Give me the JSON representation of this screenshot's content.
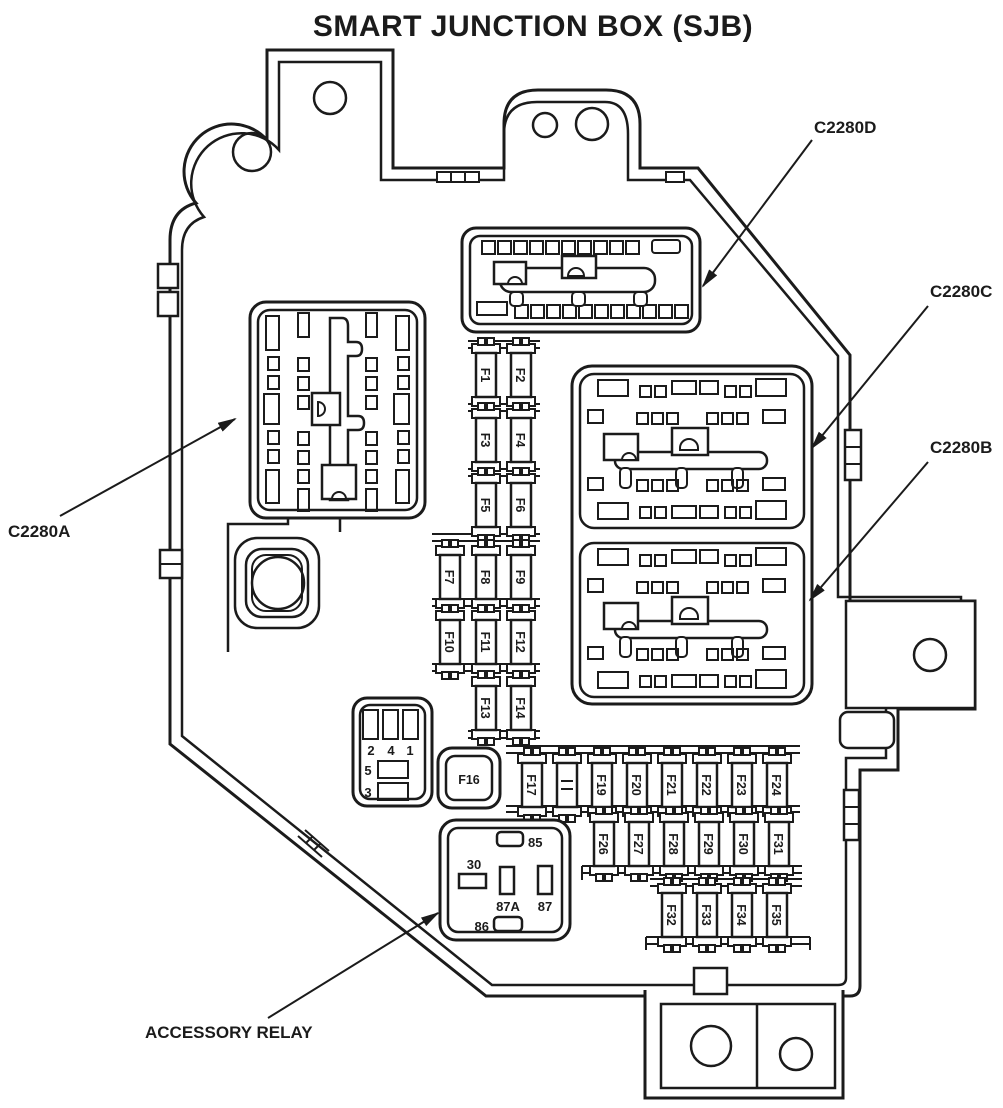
{
  "title": "SMART JUNCTION BOX (SJB)",
  "colors": {
    "ink": "#1b1b1b",
    "paper": "#ffffff"
  },
  "callouts": {
    "c2280a": "C2280A",
    "c2280b": "C2280B",
    "c2280c": "C2280C",
    "c2280d": "C2280D",
    "accessory_relay": "ACCESSORY RELAY"
  },
  "fuses": {
    "f1": "F1",
    "f2": "F2",
    "f3": "F3",
    "f4": "F4",
    "f5": "F5",
    "f6": "F6",
    "f7": "F7",
    "f8": "F8",
    "f9": "F9",
    "f10": "F10",
    "f11": "F11",
    "f12": "F12",
    "f13": "F13",
    "f14": "F14",
    "f16": "F16",
    "f17": "F17",
    "f19": "F19",
    "f20": "F20",
    "f21": "F21",
    "f22": "F22",
    "f23": "F23",
    "f24": "F24",
    "f26": "F26",
    "f27": "F27",
    "f28": "F28",
    "f29": "F29",
    "f30": "F30",
    "f31": "F31",
    "f32": "F32",
    "f33": "F33",
    "f34": "F34",
    "f35": "F35"
  },
  "relay": {
    "pins": {
      "p30": "30",
      "p85": "85",
      "p86": "86",
      "p87": "87",
      "p87a": "87A"
    }
  },
  "aux_connector": {
    "pins": {
      "p1": "1",
      "p2": "2",
      "p3": "3",
      "p4": "4",
      "p5": "5"
    }
  }
}
